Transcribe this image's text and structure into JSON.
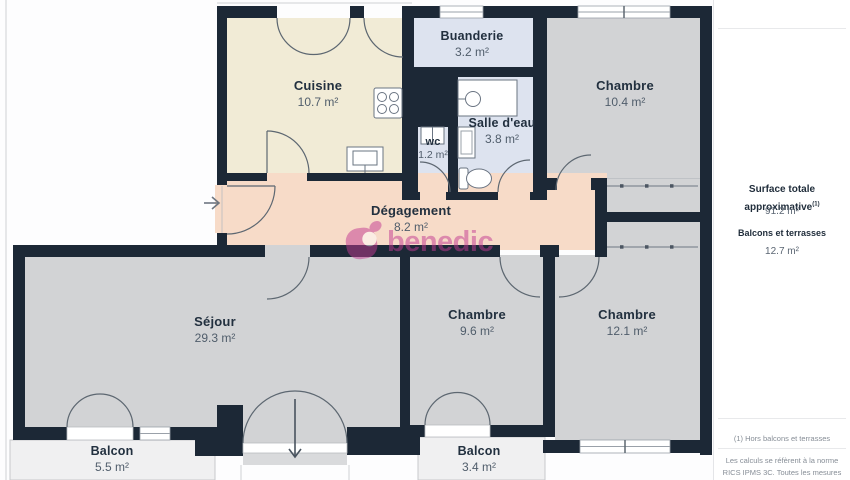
{
  "watermark": {
    "brand": "benedic",
    "color": "#c23a92"
  },
  "plan": {
    "rooms": [
      {
        "key": "cuisine",
        "name": "Cuisine",
        "area": "10.7 m²"
      },
      {
        "key": "buanderie",
        "name": "Buanderie",
        "area": "3.2 m²"
      },
      {
        "key": "salle-eau",
        "name": "Salle d'eau",
        "area": "3.8 m²"
      },
      {
        "key": "wc",
        "name": "wc",
        "area": "1.2 m²"
      },
      {
        "key": "degagement",
        "name": "Dégagement",
        "area": "8.2 m²"
      },
      {
        "key": "chambre-1",
        "name": "Chambre",
        "area": "10.4 m²"
      },
      {
        "key": "sejour",
        "name": "Séjour",
        "area": "29.3 m²"
      },
      {
        "key": "chambre-2",
        "name": "Chambre",
        "area": "9.6 m²"
      },
      {
        "key": "chambre-3",
        "name": "Chambre",
        "area": "12.1 m²"
      },
      {
        "key": "balcon-1",
        "name": "Balcon",
        "area": "5.5 m²"
      },
      {
        "key": "balcon-2",
        "name": "Balcon",
        "area": "3.4 m²"
      }
    ]
  },
  "sidebar": {
    "surface_total_label": "Surface totale approximative",
    "surface_total_sup": "(1)",
    "surface_total_value": "91.2 m²",
    "balconies_label": "Balcons et terrasses",
    "balconies_value": "12.7 m²",
    "footnote": "(1) Hors balcons et terrasses",
    "disclaimer": "Les calculs se réfèrent à la norme RICS IPMS 3C. Toutes les mesures sont"
  },
  "colors": {
    "wall": "#1c2836",
    "room_gray": "#d2d3d5",
    "kitchen": "#f1ebd6",
    "wet_rooms": "#dde3ef",
    "hallway": "#f7dbc8",
    "balcony": "#f0f0f1",
    "watermark_pink": "#c23a92"
  }
}
